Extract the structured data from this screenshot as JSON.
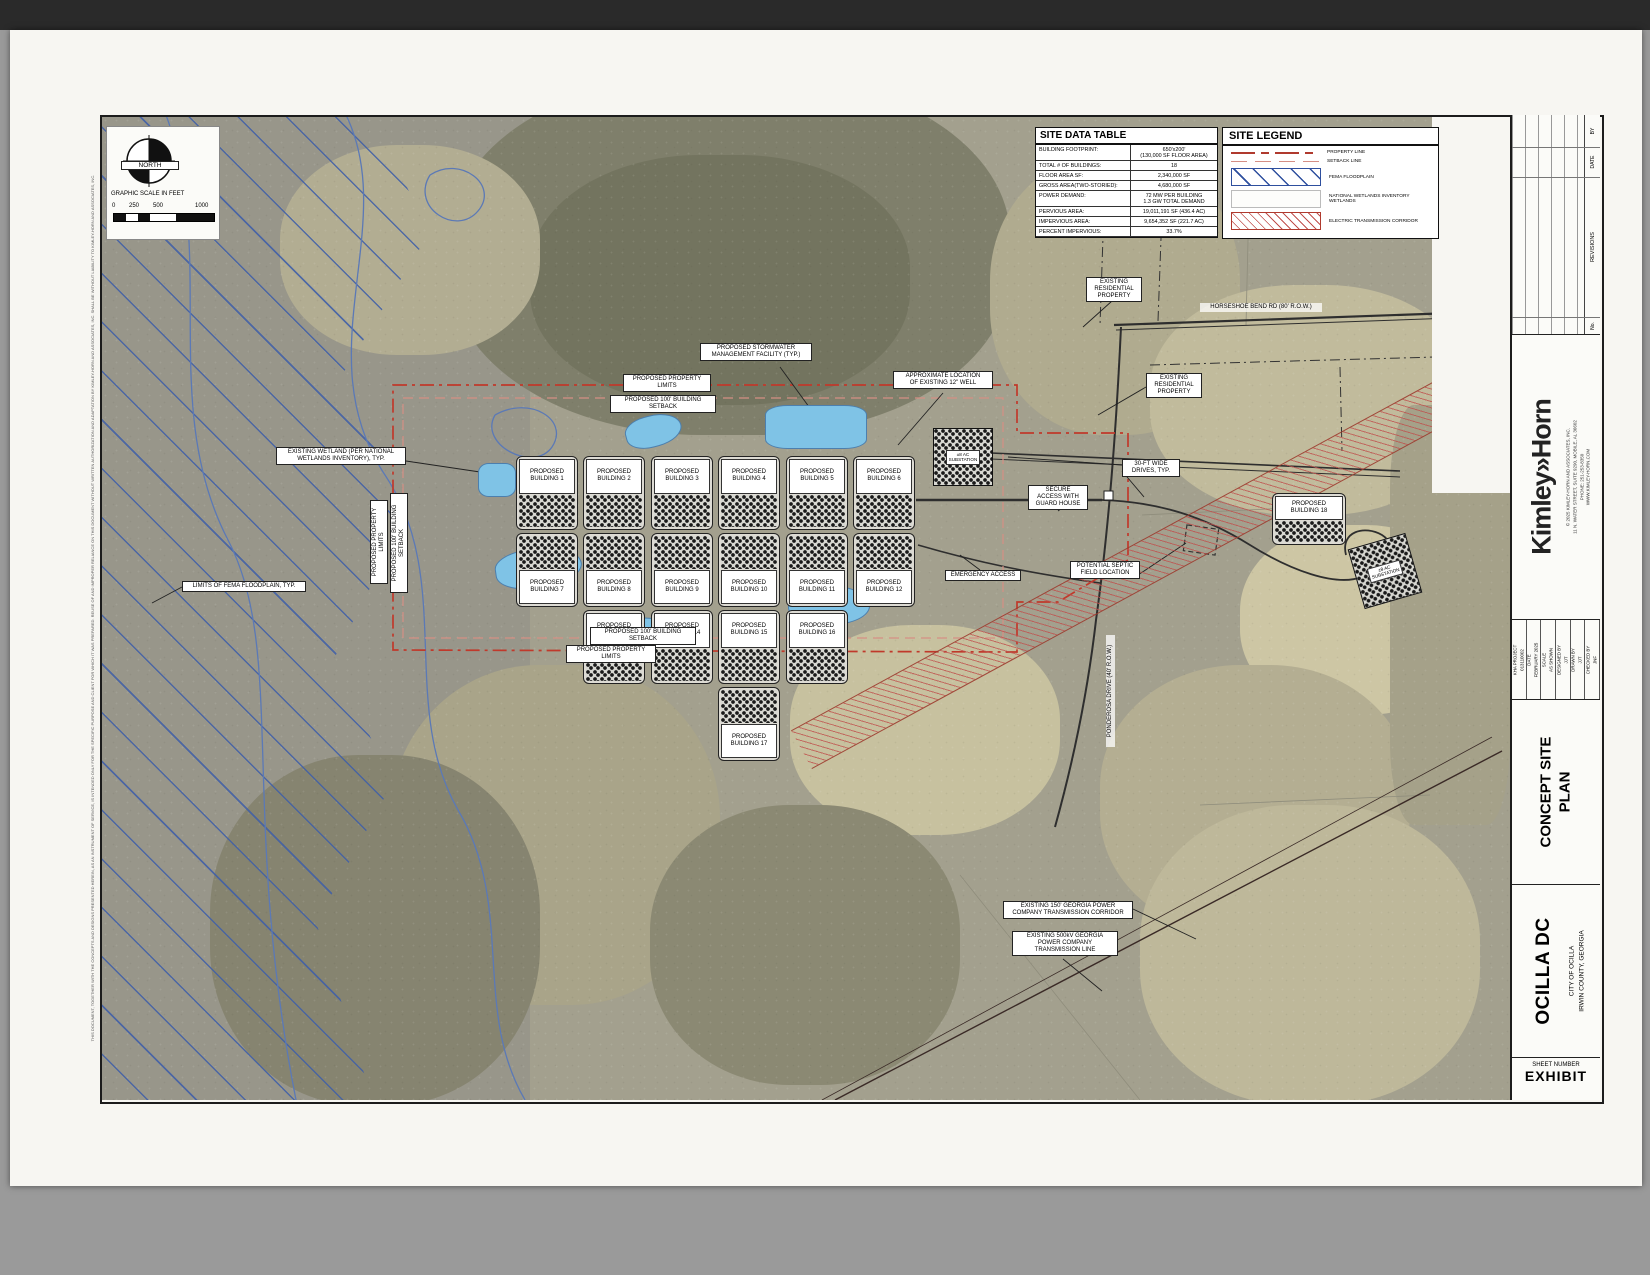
{
  "compass": {
    "label": "NORTH"
  },
  "scale_bar": {
    "title": "GRAPHIC SCALE IN FEET",
    "ticks": [
      "0",
      "250",
      "500",
      "1000"
    ]
  },
  "site_data_table": {
    "title": "SITE DATA TABLE",
    "rows": [
      {
        "label": "BUILDING FOOTPRINT:",
        "value": "650'x200'\n(130,000 SF FLOOR AREA)"
      },
      {
        "label": "TOTAL # OF BUILDINGS:",
        "value": "18"
      },
      {
        "label": "FLOOR AREA SF:",
        "value": "2,340,000 SF"
      },
      {
        "label": "GROSS AREA(TWO-STORIED):",
        "value": "4,680,000 SF"
      },
      {
        "label": "POWER DEMAND:",
        "value": "72 MW PER BUILDING\n1.3 GW TOTAL DEMAND"
      },
      {
        "label": "PERVIOUS AREA:",
        "value": "19,011,191 SF (436.4 AC)"
      },
      {
        "label": "IMPERVIOUS AREA:",
        "value": "9,654,352 SF (221.7 AC)"
      },
      {
        "label": "PERCENT IMPERVIOUS:",
        "value": "33.7%"
      }
    ]
  },
  "site_legend": {
    "title": "SITE LEGEND",
    "items": [
      {
        "label": "PROPERTY LINE",
        "swatch": "property"
      },
      {
        "label": "SETBACK LINE",
        "swatch": "setback"
      },
      {
        "label": "FEMA FLOODPLAIN",
        "swatch": "fema"
      },
      {
        "label": "NATIONAL WETLANDS INVENTORY WETLANDS",
        "swatch": "nwi"
      },
      {
        "label": "ELECTRIC TRANSMISSION CORRIDOR",
        "swatch": "corridor"
      }
    ]
  },
  "building_label_prefix": "PROPOSED",
  "buildings": [
    {
      "name": "BUILDING 1",
      "x": 416,
      "y": 341,
      "w": 62,
      "h": 74,
      "label": "top"
    },
    {
      "name": "BUILDING 2",
      "x": 483,
      "y": 341,
      "w": 62,
      "h": 74,
      "label": "top"
    },
    {
      "name": "BUILDING 3",
      "x": 551,
      "y": 341,
      "w": 62,
      "h": 74,
      "label": "top"
    },
    {
      "name": "BUILDING 4",
      "x": 618,
      "y": 341,
      "w": 62,
      "h": 74,
      "label": "top"
    },
    {
      "name": "BUILDING 5",
      "x": 686,
      "y": 341,
      "w": 62,
      "h": 74,
      "label": "top"
    },
    {
      "name": "BUILDING 6",
      "x": 753,
      "y": 341,
      "w": 62,
      "h": 74,
      "label": "top"
    },
    {
      "name": "BUILDING 7",
      "x": 416,
      "y": 418,
      "w": 62,
      "h": 74,
      "label": "bottom"
    },
    {
      "name": "BUILDING 8",
      "x": 483,
      "y": 418,
      "w": 62,
      "h": 74,
      "label": "bottom"
    },
    {
      "name": "BUILDING 9",
      "x": 551,
      "y": 418,
      "w": 62,
      "h": 74,
      "label": "bottom"
    },
    {
      "name": "BUILDING 10",
      "x": 618,
      "y": 418,
      "w": 62,
      "h": 74,
      "label": "bottom"
    },
    {
      "name": "BUILDING 11",
      "x": 686,
      "y": 418,
      "w": 62,
      "h": 74,
      "label": "bottom"
    },
    {
      "name": "BUILDING 12",
      "x": 753,
      "y": 418,
      "w": 62,
      "h": 74,
      "label": "bottom"
    },
    {
      "name": "BUILDING 13",
      "x": 483,
      "y": 495,
      "w": 62,
      "h": 74,
      "label": "top"
    },
    {
      "name": "BUILDING 14",
      "x": 551,
      "y": 495,
      "w": 62,
      "h": 74,
      "label": "top"
    },
    {
      "name": "BUILDING 15",
      "x": 618,
      "y": 495,
      "w": 62,
      "h": 74,
      "label": "top"
    },
    {
      "name": "BUILDING 16",
      "x": 686,
      "y": 495,
      "w": 62,
      "h": 74,
      "label": "top"
    },
    {
      "name": "BUILDING 17",
      "x": 618,
      "y": 572,
      "w": 62,
      "h": 74,
      "label": "bottom"
    },
    {
      "name": "BUILDING 18",
      "x": 1172,
      "y": 378,
      "w": 74,
      "h": 52,
      "label": "top"
    }
  ],
  "substations": [
    {
      "text": "±8 AC\nSUBSTATION",
      "x": 833,
      "y": 313,
      "w": 58,
      "h": 56,
      "rot": 0
    },
    {
      "text": "±8 AC\nSUBSTATION",
      "x": 1255,
      "y": 425,
      "w": 58,
      "h": 60,
      "rot": -16
    }
  ],
  "callouts": [
    {
      "text": "PROPOSED STORMWATER\nMANAGEMENT FACILITY (TYP.)",
      "x": 600,
      "y": 228,
      "w": 112
    },
    {
      "text": "PROPOSED PROPERTY LIMITS",
      "x": 523,
      "y": 259,
      "w": 88
    },
    {
      "text": "PROPOSED 100' BUILDING SETBACK",
      "x": 510,
      "y": 280,
      "w": 106
    },
    {
      "text": "APPROXIMATE LOCATION\nOF EXISTING 12\" WELL",
      "x": 793,
      "y": 256,
      "w": 100
    },
    {
      "text": "EXISTING\nRESIDENTIAL\nPROPERTY",
      "x": 986,
      "y": 162,
      "w": 56
    },
    {
      "text": "HORSESHOE BEND RD (80' R.O.W.)",
      "x": 1100,
      "y": 188,
      "w": 122,
      "plain": true
    },
    {
      "text": "EXISTING\nRESIDENTIAL\nPROPERTY",
      "x": 1046,
      "y": 258,
      "w": 56
    },
    {
      "text": "EXISTING WETLAND (PER NATIONAL\nWETLANDS INVENTORY), TYP.",
      "x": 176,
      "y": 332,
      "w": 130
    },
    {
      "text": "LIMITS OF FEMA FLOODPLAIN, TYP.",
      "x": 82,
      "y": 466,
      "w": 124
    },
    {
      "text": "PROPOSED PROPERTY LIMITS",
      "x": 270,
      "y": 385,
      "h": 84,
      "vertical": true
    },
    {
      "text": "PROPOSED 100' BUILDING SETBACK",
      "x": 290,
      "y": 378,
      "h": 100,
      "vertical": true
    },
    {
      "text": "30-FT WIDE\nDRIVES, TYP.",
      "x": 1022,
      "y": 344,
      "w": 58
    },
    {
      "text": "SECURE\nACCESS WITH\nGUARD HOUSE",
      "x": 928,
      "y": 370,
      "w": 60
    },
    {
      "text": "EMERGENCY ACCESS",
      "x": 845,
      "y": 455,
      "w": 76
    },
    {
      "text": "POTENTIAL SEPTIC\nFIELD LOCATION",
      "x": 970,
      "y": 446,
      "w": 70
    },
    {
      "text": "PONDEROSA DRIVE (40' R.O.W.)",
      "x": 1006,
      "y": 520,
      "h": 112,
      "vertical": true,
      "plain": true
    },
    {
      "text": "PROPOSED 100' BUILDING SETBACK",
      "x": 490,
      "y": 512,
      "w": 106
    },
    {
      "text": "PROPOSED PROPERTY LIMITS",
      "x": 466,
      "y": 530,
      "w": 90
    },
    {
      "text": "EXISTING 150' GEORGIA POWER\nCOMPANY TRANSMISSION CORRIDOR",
      "x": 903,
      "y": 786,
      "w": 130
    },
    {
      "text": "EXISTING 500kV GEORGIA\nPOWER COMPANY\nTRANSMISSION LINE",
      "x": 912,
      "y": 816,
      "w": 106
    }
  ],
  "titleblock": {
    "revisions": {
      "by": "BY",
      "date": "DATE",
      "title": "REVISIONS",
      "no": "No."
    },
    "firm": {
      "logo": "Kimley»Horn",
      "address": "© 2025 KIMLEY-HORN AND ASSOCIATES, INC.\n11 N. WATER STREET, SUITE 9290, MOBILE, AL 36602\nPHONE: 251-253-8350\nWWW.KIMLEY-HORN.COM"
    },
    "info_columns": [
      {
        "label": "KHA PROJECT",
        "value": "013110002"
      },
      {
        "label": "DATE",
        "value": "FEBRUARY 2025"
      },
      {
        "label": "SCALE",
        "value": "AS SHOWN"
      },
      {
        "label": "DESIGNED BY",
        "value": "JJT"
      },
      {
        "label": "DRAWN BY",
        "value": "JJT"
      },
      {
        "label": "CHECKED BY",
        "value": "JNF"
      }
    ],
    "sheet_title": "CONCEPT SITE\nPLAN",
    "project": {
      "name": "OCILLA DC",
      "sub1": "CITY OF OCILLA",
      "sub2": "IRWIN COUNTY, GEORGIA"
    },
    "sheet_number": {
      "label": "SHEET NUMBER",
      "value": "EXHIBIT"
    }
  },
  "margin_note": "THIS DOCUMENT, TOGETHER WITH THE CONCEPTS AND DESIGNS PRESENTED HEREIN, AS AN INSTRUMENT OF SERVICE, IS INTENDED ONLY FOR THE SPECIFIC PURPOSE AND CLIENT FOR WHICH IT WAS PREPARED. REUSE OF AND IMPROPER RELIANCE ON THIS DOCUMENT WITHOUT WRITTEN AUTHORIZATION AND ADAPTATION BY KIMLEY-HORN AND ASSOCIATES, INC. SHALL BE WITHOUT LIABILITY TO KIMLEY-HORN AND ASSOCIATES, INC.",
  "colors": {
    "property_line": "#c0392b",
    "setback_line": "#d58f85",
    "fema_blue": "#3e5ea8",
    "pond_blue": "#7fc3e6",
    "corridor_red": "#c0504d"
  }
}
